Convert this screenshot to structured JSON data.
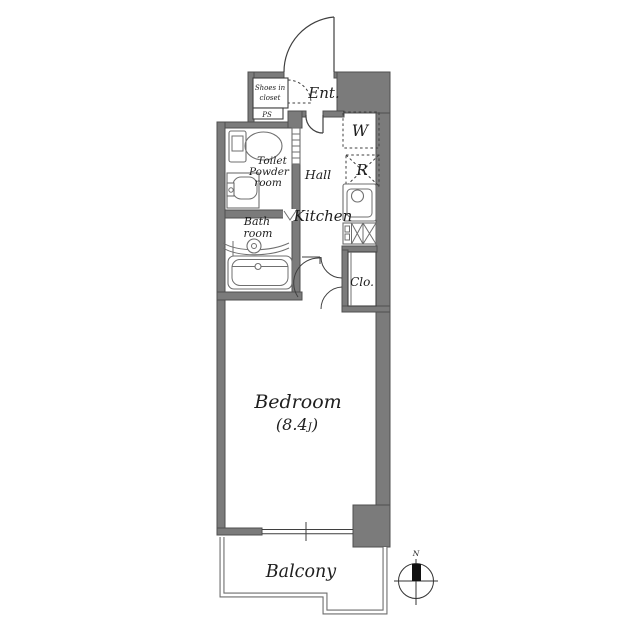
{
  "floorplan": {
    "labels": {
      "shoes_closet_1": "Shoes in",
      "shoes_closet_2": "closet",
      "ps": "PS",
      "entrance": "Ent.",
      "washer": "W",
      "fridge": "R",
      "hall": "Hall",
      "kitchen": "Kitchen",
      "toilet_1": "Toilet",
      "toilet_2": "Powder",
      "toilet_3": "room",
      "bath_1": "Bath",
      "bath_2": "room",
      "closet": "Clo.",
      "bedroom": "Bedroom",
      "bedroom_size_open": "(8.4",
      "bedroom_size_unit": "J",
      "bedroom_size_close": ")",
      "balcony": "Balcony",
      "compass_north": "N"
    },
    "colors": {
      "background": "#ffffff",
      "wall_fill": "#7b7b7b",
      "wall_edge": "#4f4f4f",
      "line": "#3f3f3f",
      "fixture_line": "#6f6f6f",
      "balcony_line": "#6e6e6e",
      "text": "#1e1e1e",
      "compass_needle": "#111111"
    }
  }
}
